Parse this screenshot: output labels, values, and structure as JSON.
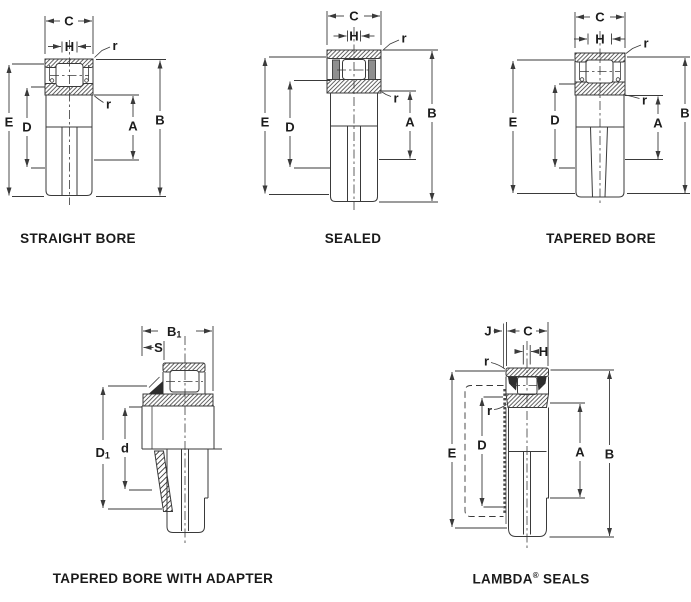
{
  "figures": {
    "straight_bore": {
      "caption": "STRAIGHT BORE",
      "labels": {
        "c": "C",
        "h": "H",
        "r_top": "r",
        "r_bottom": "r",
        "e": "E",
        "d": "D",
        "a": "A",
        "b": "B"
      }
    },
    "sealed": {
      "caption": "SEALED",
      "labels": {
        "c": "C",
        "h": "H",
        "r_top": "r",
        "r_bottom": "r",
        "e": "E",
        "d": "D",
        "a": "A",
        "b": "B"
      }
    },
    "tapered_bore": {
      "caption": "TAPERED BORE",
      "labels": {
        "c": "C",
        "h": "H",
        "r_top": "r",
        "r_bottom": "r",
        "e": "E",
        "d": "D",
        "a": "A",
        "b": "B"
      }
    },
    "tapered_bore_with_adapter": {
      "caption": "TAPERED BORE WITH ADAPTER",
      "labels": {
        "b1_main": "B",
        "b1_sub": "1",
        "s": "S",
        "d1_main": "D",
        "d1_sub": "1",
        "d": "d"
      }
    },
    "lambda_seals": {
      "caption_pre": "LAMBDA",
      "caption_sup": "®",
      "caption_post": " SEALS",
      "labels": {
        "j": "J",
        "c": "C",
        "h": "H",
        "r_top": "r",
        "r_bottom": "r",
        "e": "E",
        "d": "D",
        "a": "A",
        "b": "B"
      }
    }
  },
  "colors": {
    "line": "#3a3a3a",
    "text": "#1c1c1c",
    "background": "#ffffff"
  }
}
